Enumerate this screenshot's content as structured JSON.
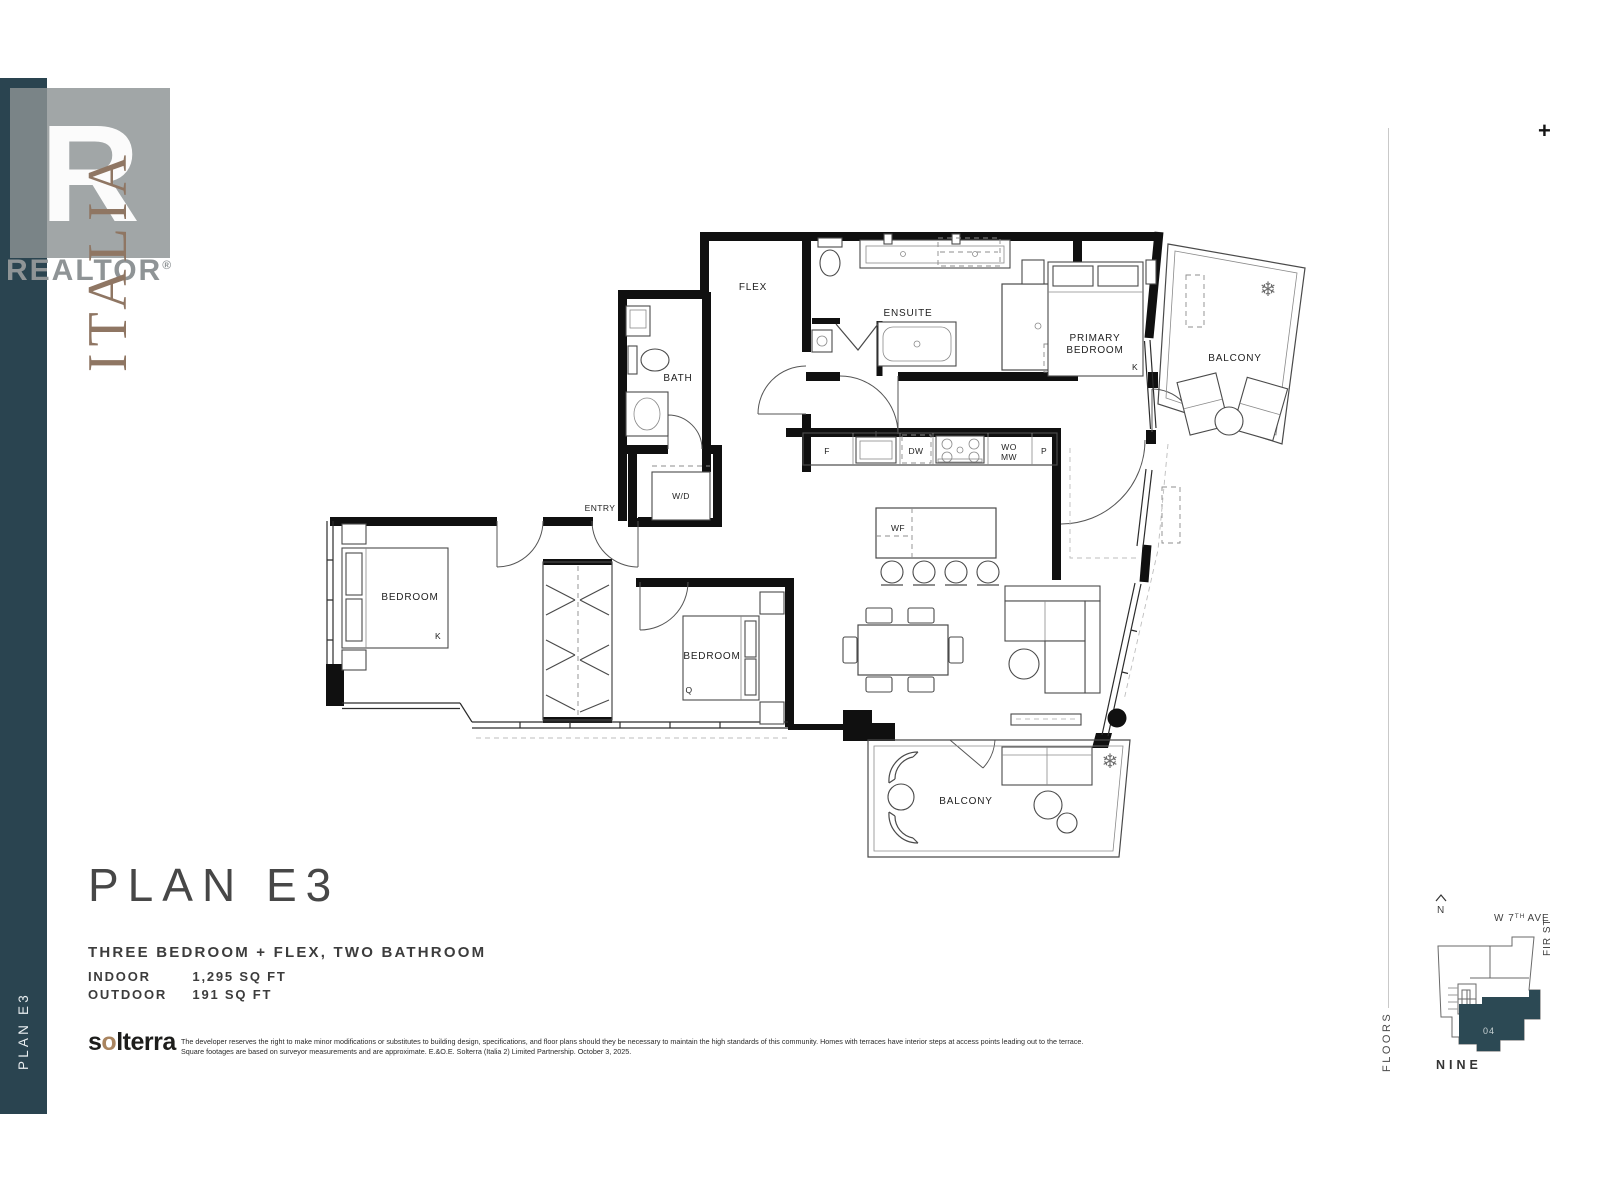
{
  "colors": {
    "sidebar_teal": "#2a4450",
    "unit_highlight": "#2c4954",
    "italia_brown": "#8f7663",
    "solterra_accent": "#a9845f"
  },
  "toolbar": {
    "zoom_plus": "+"
  },
  "sidebar": {
    "plan_label": "PLAN E3"
  },
  "watermark": {
    "r_letter": "R",
    "realtor_text": "REALTOR",
    "registered": "®",
    "italia_text": "ITALIA"
  },
  "plan_info": {
    "title": "PLAN E3",
    "subtitle": "THREE BEDROOM + FLEX, TWO BATHROOM",
    "indoor_label": "INDOOR",
    "indoor_value": "1,295 SQ FT",
    "outdoor_label": "OUTDOOR",
    "outdoor_value": "191 SQ FT"
  },
  "footer": {
    "logo_prefix": "s",
    "logo_o": "o",
    "logo_suffix": "lterra",
    "disclaimer_line1": "The developer reserves the right to make minor modifications or substitutes to building design, specifications, and floor plans should they be necessary to maintain the high standards of this community. Homes with terraces have interior steps at access points leading out to the terrace.",
    "disclaimer_line2": "Square footages are based on surveyor measurements and are approximate. E.&O.E. Solterra (Italia 2) Limited Partnership. October 3, 2025."
  },
  "floorplan": {
    "rooms": {
      "flex": "FLEX",
      "bath": "BATH",
      "ensuite": "ENSUITE",
      "primary_bedroom_line1": "PRIMARY",
      "primary_bedroom_line2": "BEDROOM",
      "balcony_top": "BALCONY",
      "balcony_bottom": "BALCONY",
      "entry": "ENTRY",
      "laundry": "W/D",
      "bedroom_left": "BEDROOM",
      "bedroom_middle": "BEDROOM"
    },
    "beds": {
      "king_left": "K",
      "king_primary": "K",
      "queen_middle": "Q"
    },
    "kitchen": {
      "fridge": "F",
      "dishwasher": "DW",
      "wall_oven": "WO",
      "microwave": "MW",
      "pantry": "P",
      "wine_fridge": "WF"
    }
  },
  "keyplan": {
    "north_label": "N",
    "street_prefix": "W 7",
    "street_sup": "TH",
    "street_suffix": "AVE",
    "street_right": "FIR ST",
    "floors_label": "FLOORS",
    "floor_name": "NINE",
    "unit_number": "04"
  }
}
